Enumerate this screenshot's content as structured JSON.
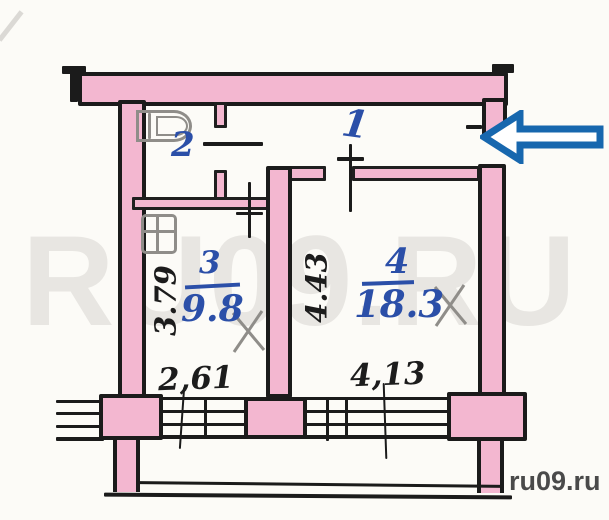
{
  "floor_plan": {
    "type": "apartment-plan-scan",
    "room_labels": {
      "hall": "1",
      "bath": "2",
      "kitchen": "3",
      "living": "4"
    },
    "areas": {
      "kitchen": "9.8",
      "living": "18.3"
    },
    "dims": {
      "kitchen_width": "2,61",
      "kitchen_depth": "3.79",
      "living_width": "4,13",
      "living_depth": "4.43"
    },
    "icons": {
      "entrance_arrow": "entrance-arrow-icon",
      "bathtub": "bathtub-icon",
      "sink": "sink-icon",
      "pencil_x": "pencil-x-mark"
    },
    "colors": {
      "wall_pink": "#f3b7d0",
      "outline_black": "#1b1b1b",
      "ink_blue": "#2b4fa8",
      "pencil_gray": "#8f8d89",
      "arrow_blue": "#1767ae",
      "paper": "#fcfbf7",
      "watermark_gray": "#e8e6e2"
    }
  },
  "watermarks": {
    "large": "RU09.RU",
    "small": "ru09.ru"
  }
}
